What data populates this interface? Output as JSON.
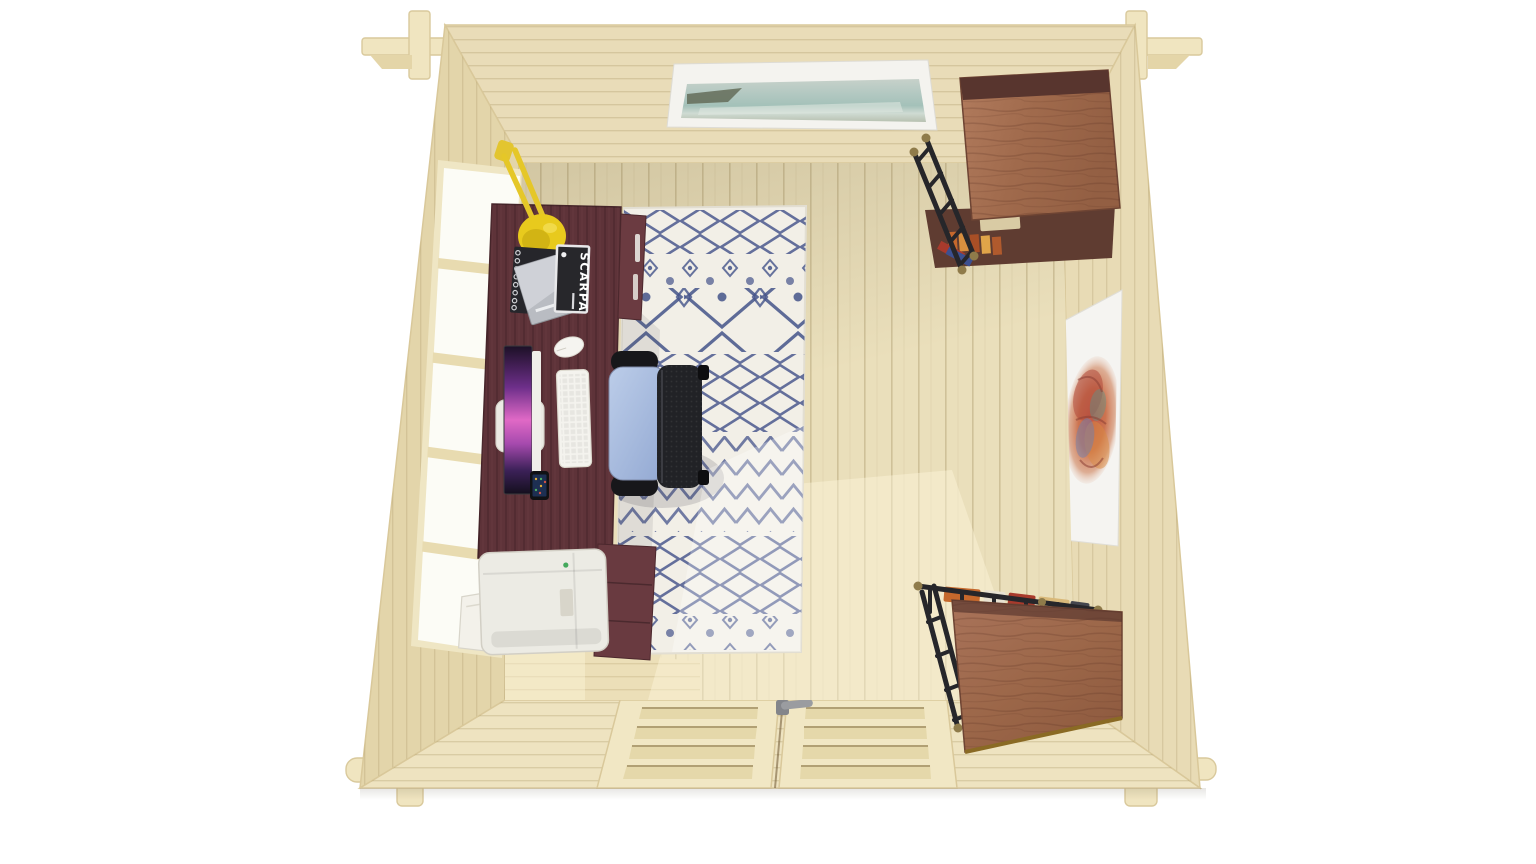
{
  "scene": {
    "description": "Top-down 3D render of a square log-cabin garden office interior",
    "view": "overhead",
    "magazine_title": "SCARPA",
    "window": {
      "panes": 5,
      "wall": "left"
    },
    "double_door": {
      "leaves": 2,
      "panels_per_leaf": 4,
      "wall": "bottom"
    },
    "artworks": {
      "top_wall": "framed seascape painting",
      "right_wall": "framed abstract scribble print"
    },
    "furniture": [
      "desk",
      "office-chair",
      "rug",
      "printer-cabinet",
      "printer",
      "drawer-pedestal",
      "shelf-unit-top-right",
      "shelf-unit-bottom-right"
    ],
    "desk_items": [
      "desk-lamp",
      "spiral-notebook",
      "brochure",
      "magazine",
      "monitor",
      "keyboard",
      "mouse",
      "smartphone"
    ],
    "palette": {
      "background": "#ffffff",
      "wall_wood": "#e7dab2",
      "floor_wood": "#eadfbb",
      "desk_mahogany": "#5e3339",
      "rug_base": "#f2efe7",
      "rug_pattern_navy": "#44538a",
      "lamp_yellow": "#e8c81f",
      "chair_seat_blue": "#aec2e5",
      "shelf_wood_brown": "#a87458",
      "metal_black": "#2a2a2e",
      "frame_white": "#f5f4f0",
      "door_handle_grey": "#97999c"
    }
  }
}
